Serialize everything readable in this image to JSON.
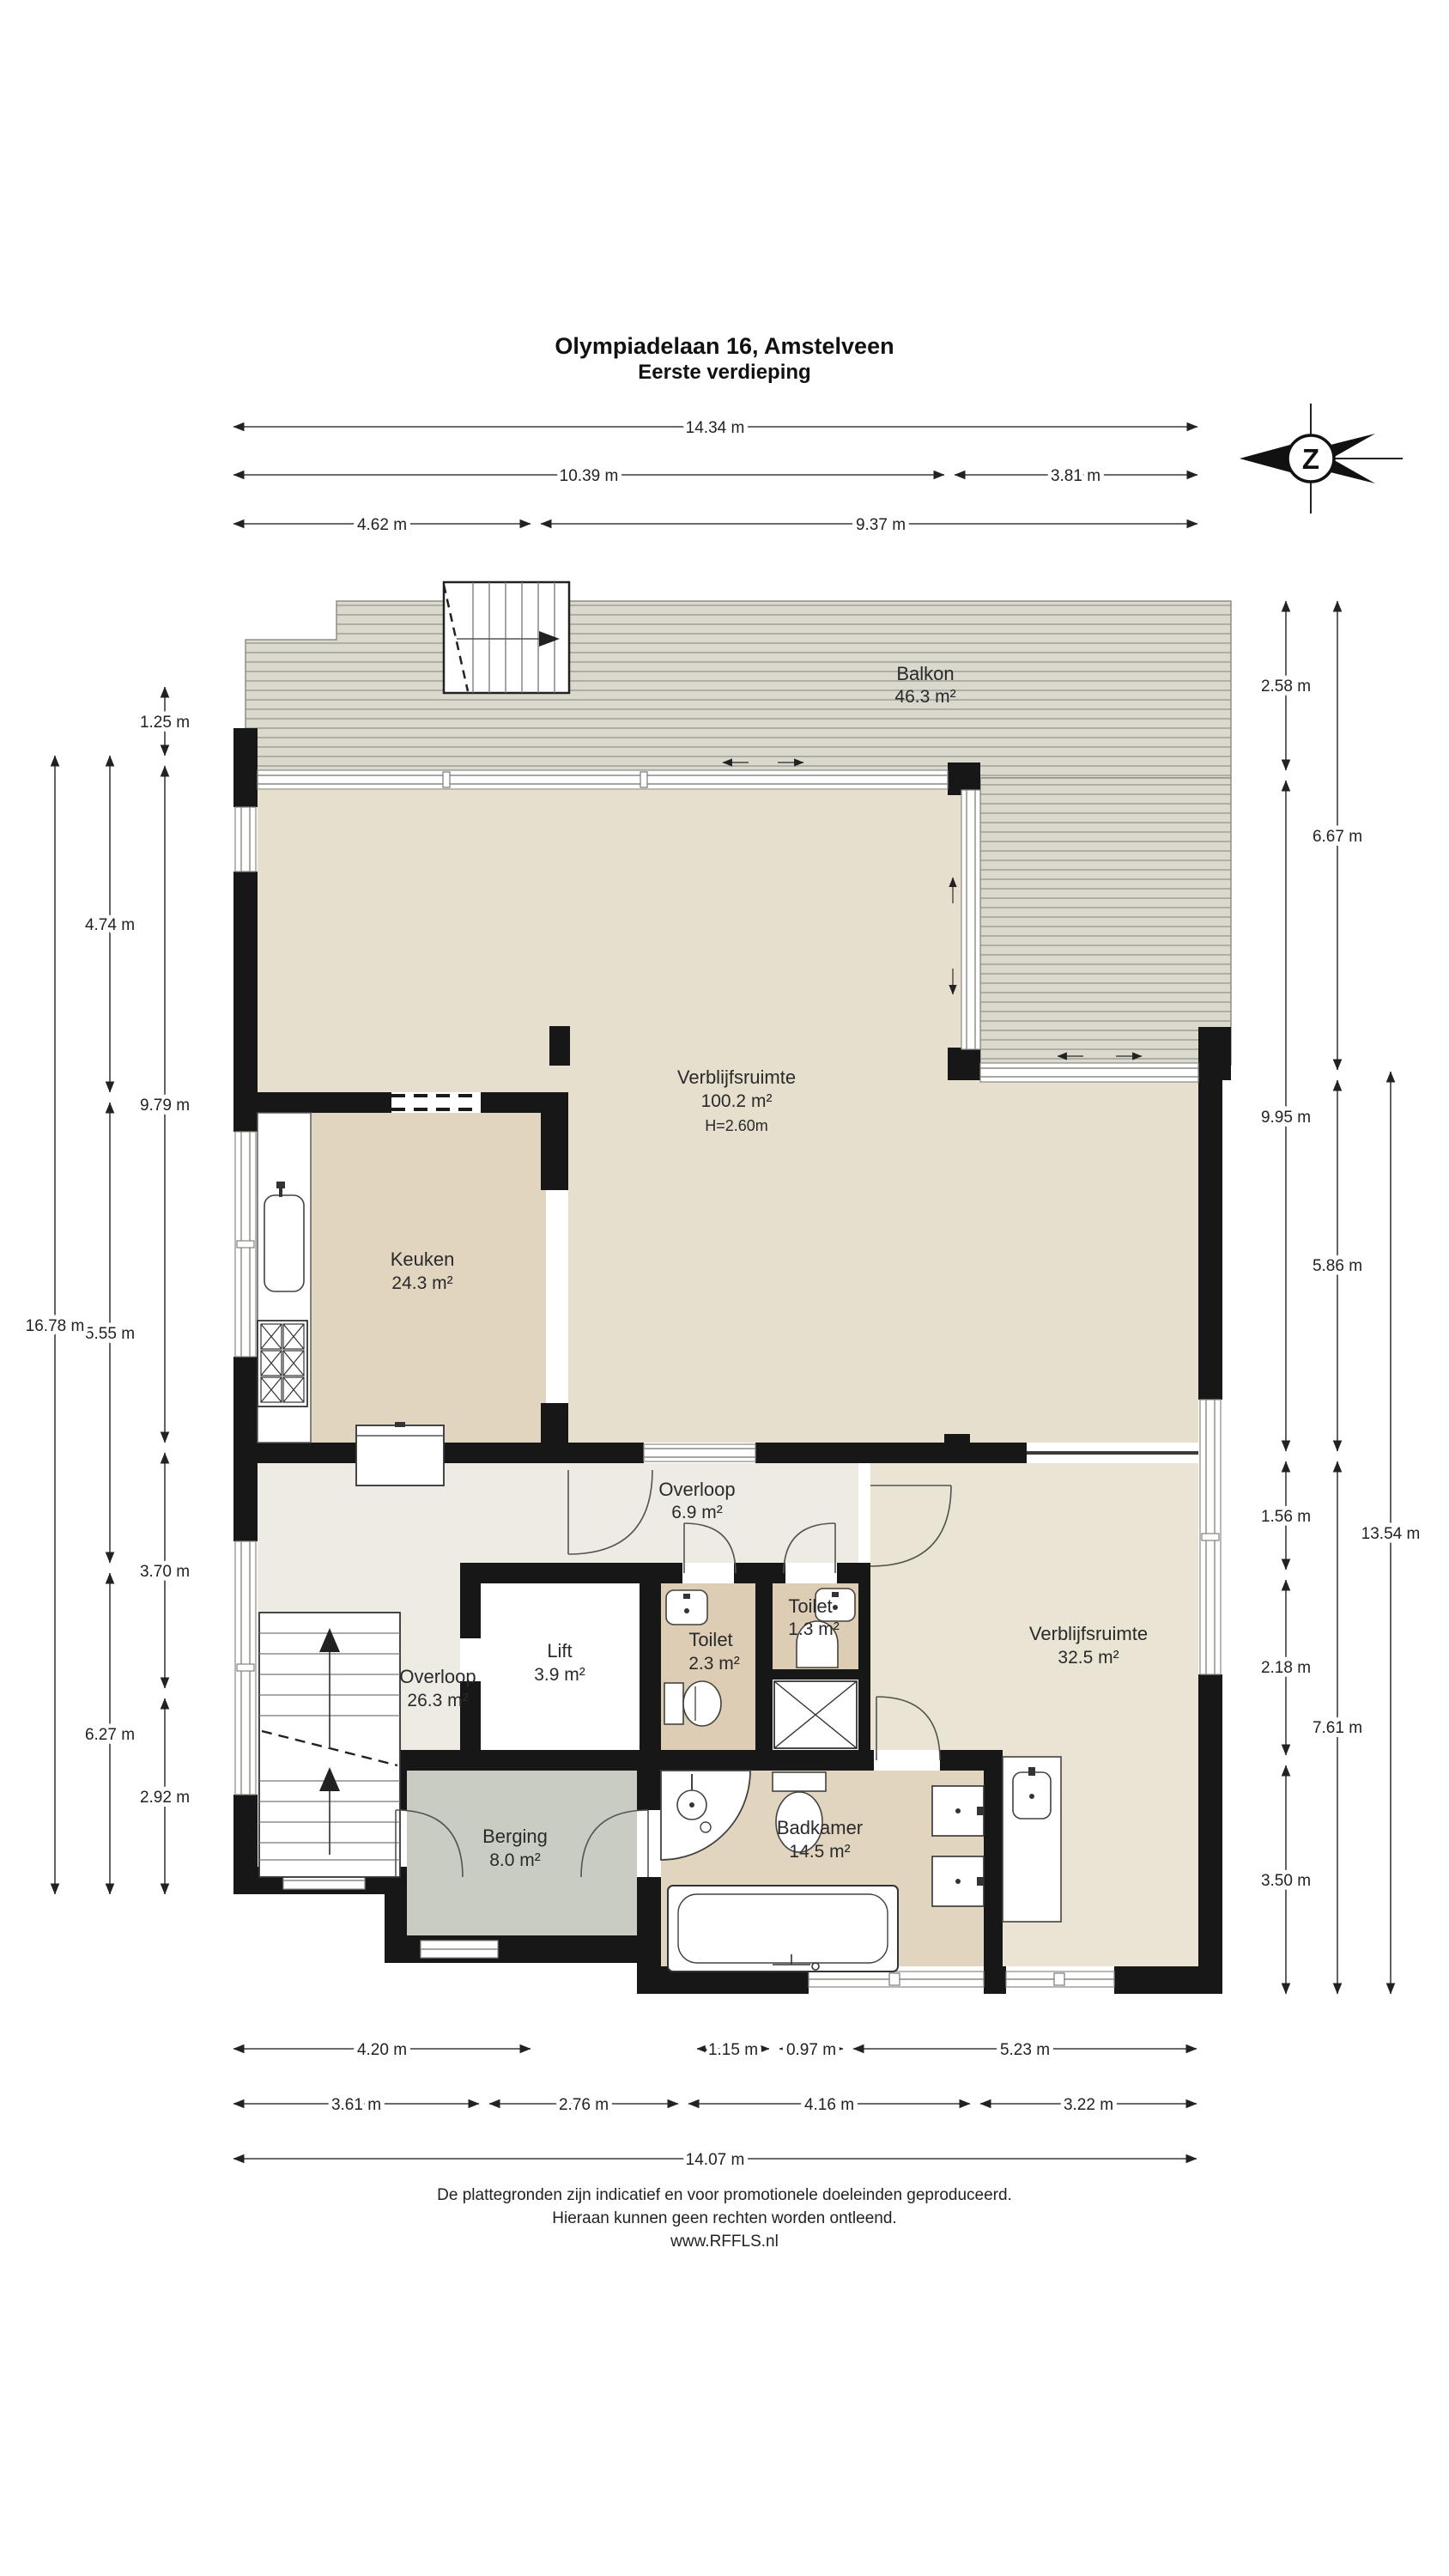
{
  "title": {
    "line1": "Olympiadelaan 16, Amstelveen",
    "line2": "Eerste verdieping"
  },
  "compass": {
    "letter": "Z"
  },
  "rooms": {
    "balkon": {
      "name": "Balkon",
      "area": "46.3 m²"
    },
    "verblijf1": {
      "name": "Verblijfsruimte",
      "area": "100.2 m²",
      "height": "H=2.60m"
    },
    "keuken": {
      "name": "Keuken",
      "area": "24.3 m²"
    },
    "overloop1": {
      "name": "Overloop",
      "area": "6.9 m²"
    },
    "lift": {
      "name": "Lift",
      "area": "3.9 m²"
    },
    "toilet1": {
      "name": "Toilet",
      "area": "2.3 m²"
    },
    "toilet2": {
      "name": "Toilet",
      "area": "1.3 m²"
    },
    "overloop2": {
      "name": "Overloop",
      "area": "26.3 m²"
    },
    "verblijf2": {
      "name": "Verblijfsruimte",
      "area": "32.5 m²"
    },
    "berging": {
      "name": "Berging",
      "area": "8.0 m²"
    },
    "badkamer": {
      "name": "Badkamer",
      "area": "14.5 m²"
    }
  },
  "dims": {
    "top": [
      "14.34 m",
      "10.39 m",
      "3.81 m",
      "4.62 m",
      "9.37 m"
    ],
    "left": [
      "1.25 m",
      "9.79 m",
      "3.70 m",
      "2.92 m",
      "4.74 m",
      "5.55 m",
      "6.27 m",
      "16.78 m"
    ],
    "right": [
      "2.58 m",
      "9.95 m",
      "1.56 m",
      "2.18 m",
      "3.50 m",
      "6.67 m",
      "5.86 m",
      "7.61 m",
      "13.54 m"
    ],
    "bottom": [
      "4.20 m",
      "1.15 m",
      "0.97 m",
      "5.23 m",
      "3.61 m",
      "2.76 m",
      "4.16 m",
      "3.22 m",
      "14.07 m"
    ]
  },
  "footer": {
    "line1": "De plattegronden zijn indicatief en voor promotionele doeleinden geproduceerd.",
    "line2": "Hieraan kunnen geen rechten worden ontleend.",
    "line3": "www.RFFLS.nl"
  },
  "colors": {
    "wall": "#171717",
    "living": "#e7dfcd",
    "kitchen_bath": "#e1d5bf",
    "toilet": "#dccdb4",
    "room32": "#eae4d4",
    "hall": "#edebe3",
    "storage": "#c9ccc3",
    "deck": "#dbd8cd",
    "deck_line": "#a3a399"
  }
}
